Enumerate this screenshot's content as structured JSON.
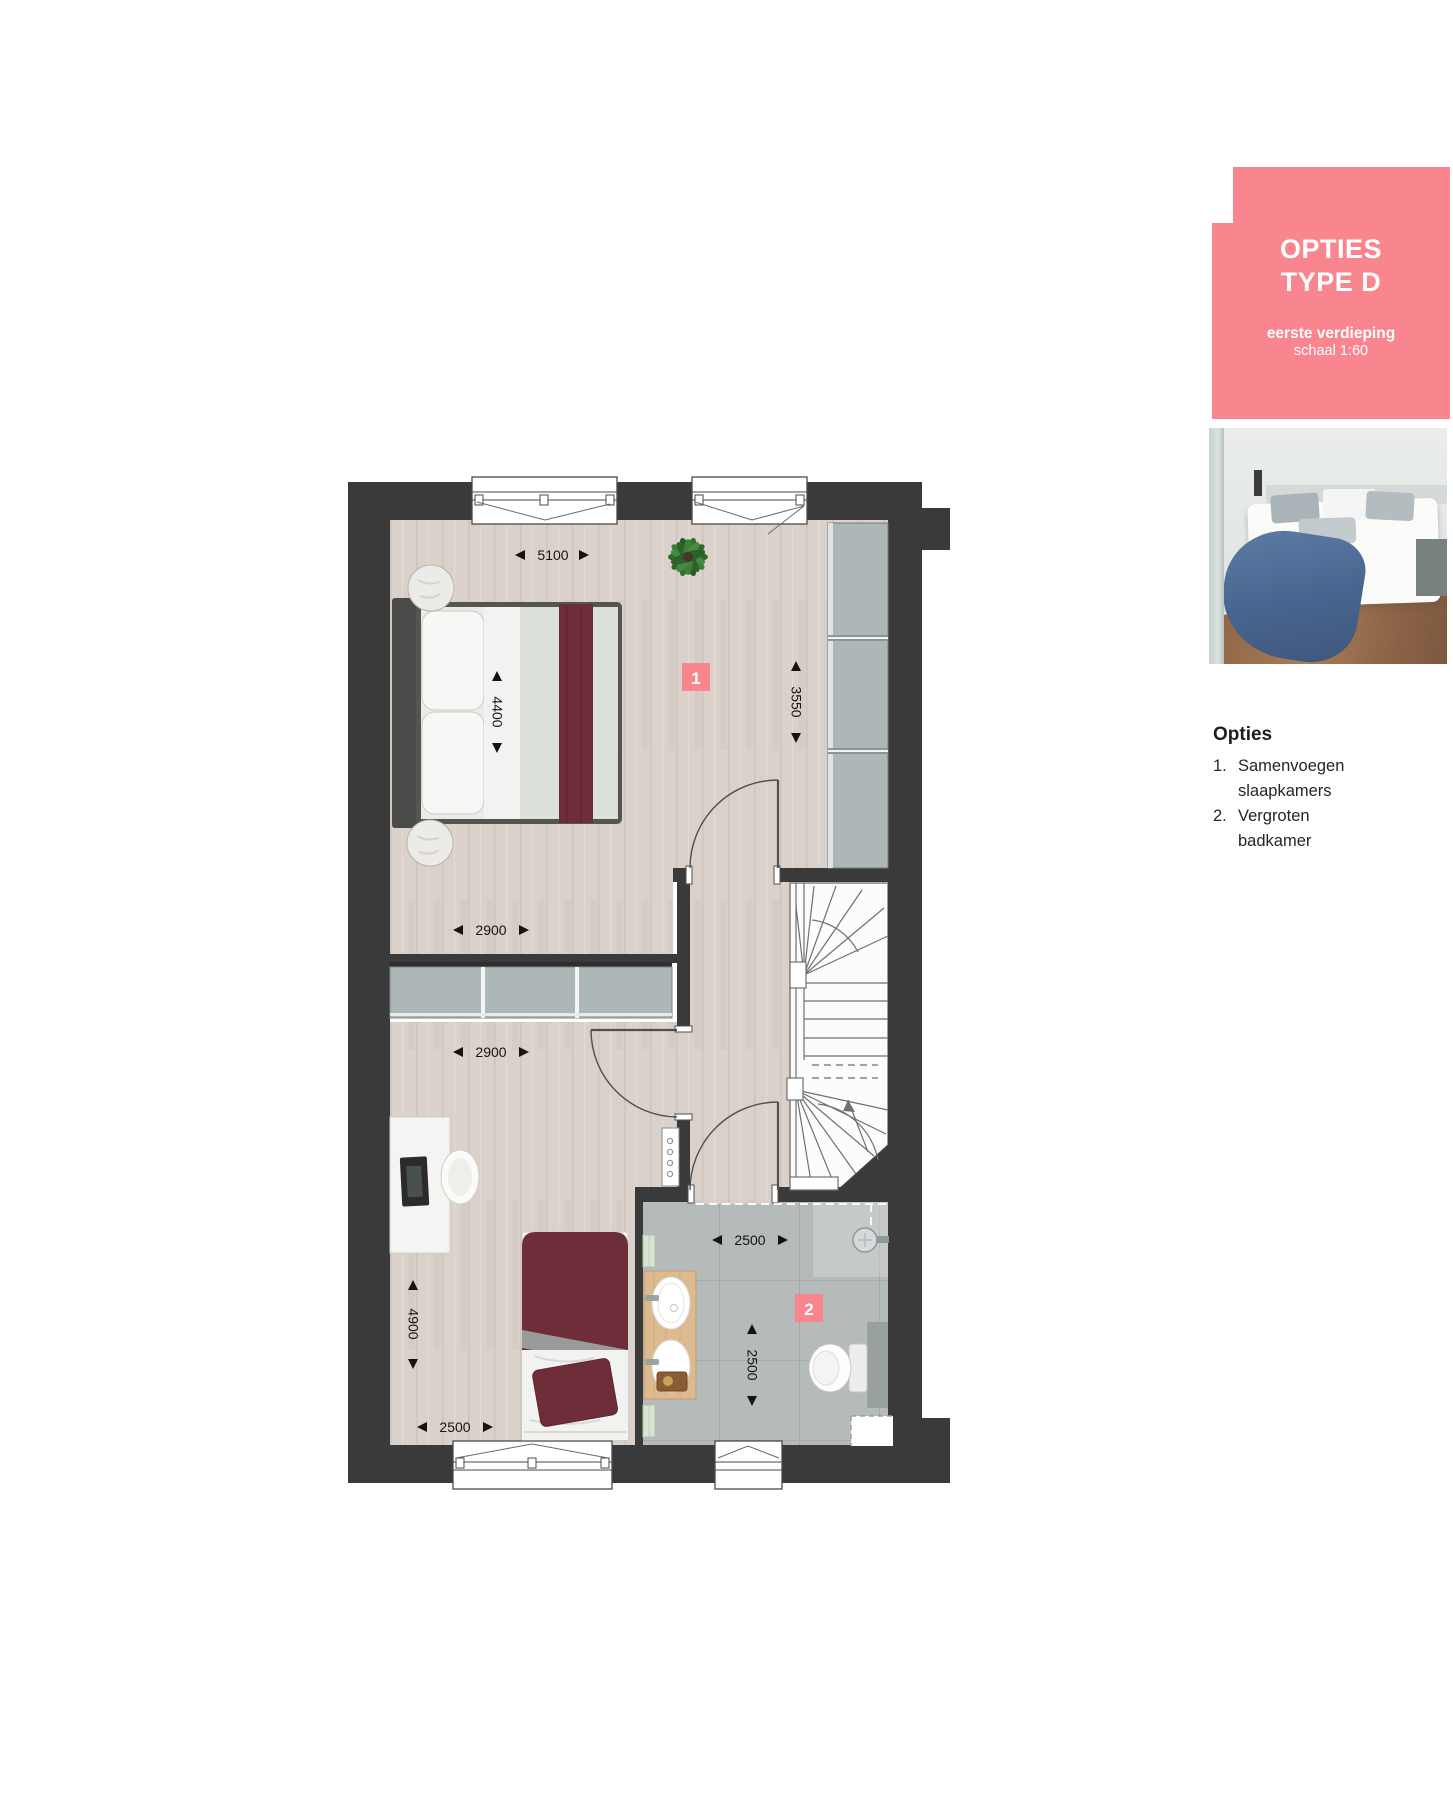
{
  "card": {
    "title_line1": "OPTIES",
    "title_line2": "TYPE D",
    "subtitle_bold": "eerste verdieping",
    "subtitle": "schaal 1:60"
  },
  "options": {
    "heading": "Opties",
    "items": [
      {
        "num": "1.",
        "line1": "Samenvoegen",
        "line2": "slaapkamers"
      },
      {
        "num": "2.",
        "line1": "Vergroten",
        "line2": "badkamer"
      }
    ]
  },
  "plan": {
    "markers": [
      {
        "label": "1"
      },
      {
        "label": "2"
      }
    ],
    "dimensions": {
      "bedroom1_width": "5100",
      "bed_length": "4400",
      "wardrobe_wall": "3550",
      "bedroom1_lower_width": "2900",
      "bedroom2_width": "2900",
      "bedroom2_depth": "4900",
      "bedroom2_bottom_width": "2500",
      "bathroom_width": "2500",
      "bathroom_depth": "2500"
    },
    "colors": {
      "wall": "#3b3a3a",
      "accent": "#f9858e",
      "wood": "#d9d1ca",
      "tile": "#b5baba"
    }
  }
}
